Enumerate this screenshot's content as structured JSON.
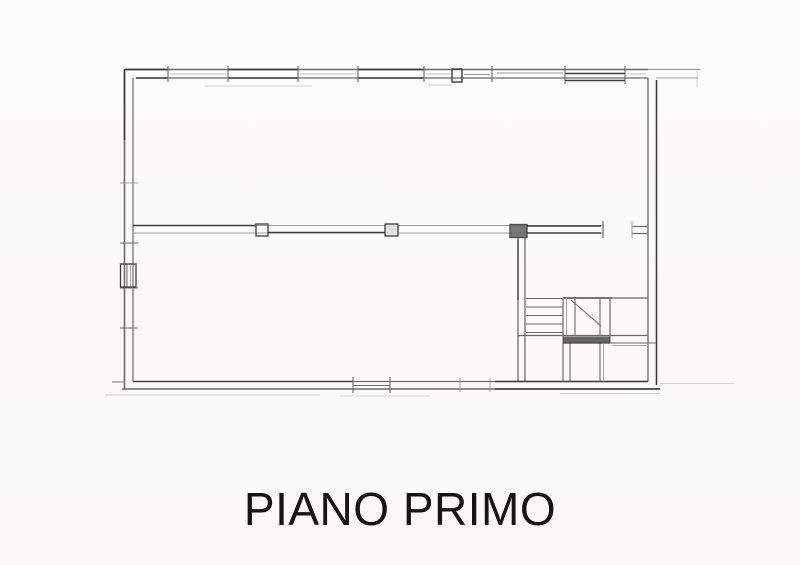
{
  "title": {
    "label": "PIANO PRIMO"
  },
  "drawing": {
    "canvas": {
      "width": 800,
      "height": 565
    },
    "ink": {
      "dark": "#3d3d3d",
      "mid": "#6a6a6a",
      "light": "#929292",
      "faint": "#b8b8b8"
    },
    "lines": [
      [
        "top-wall-outer",
        125,
        69.5,
        648,
        69.5,
        "mid",
        1.5,
        1
      ],
      [
        "top-wall-outer-extension",
        648,
        69.5,
        700,
        69.5,
        "light",
        1.3,
        0.9
      ],
      [
        "top-wall-outer-dark-1",
        125,
        69.5,
        168,
        69.5,
        "dark",
        1.7,
        1
      ],
      [
        "top-wall-outer-dark-2",
        228,
        69.5,
        298,
        69.5,
        "dark",
        1.7,
        1
      ],
      [
        "top-wall-outer-dark-3",
        358,
        69.5,
        424,
        69.5,
        "dark",
        1.7,
        1
      ],
      [
        "top-wall-inner",
        136,
        78,
        648,
        78,
        "mid",
        1.3,
        1
      ],
      [
        "top-wall-inner-dark-1",
        136,
        78,
        168,
        78,
        "dark",
        1.5,
        1
      ],
      [
        "top-wall-inner-dark-2",
        228,
        78,
        298,
        78,
        "dark",
        1.5,
        1
      ],
      [
        "top-wall-inner-dark-3",
        358,
        78,
        424,
        78,
        "dark",
        1.5,
        1
      ],
      [
        "top-wall-inner-extension",
        656,
        78,
        698,
        78,
        "light",
        1.1,
        0.85
      ],
      [
        "top-window-glass-1",
        170,
        74,
        226,
        74,
        "faint",
        1,
        0.9
      ],
      [
        "top-window-glass-2",
        300,
        74,
        356,
        74,
        "faint",
        1,
        0.9
      ],
      [
        "top-window-glass-3",
        426,
        74,
        450,
        74,
        "faint",
        1,
        0.9
      ],
      [
        "top-window-glass-4",
        464,
        74.5,
        490,
        74.5,
        "light",
        1,
        0.9
      ],
      [
        "top-window-glass-5",
        497,
        73,
        563,
        73,
        "light",
        1,
        0.9
      ],
      [
        "top-window-glass-6",
        627,
        74,
        646,
        74,
        "faint",
        1,
        0.85
      ],
      [
        "top-wall-dark-segment-upper",
        565,
        73.5,
        625,
        73.5,
        "dark",
        1.6,
        1
      ],
      [
        "top-wall-dark-segment-lower",
        565,
        80.5,
        625,
        80.5,
        "dark",
        1.6,
        1
      ],
      [
        "top-sill-faint-1",
        205,
        86,
        312,
        86,
        "faint",
        1,
        0.7
      ],
      [
        "top-sill-faint-2",
        428,
        85,
        452,
        85,
        "faint",
        1,
        0.7
      ],
      [
        "top-jamb-tick",
        168,
        66,
        168,
        82,
        "mid",
        1.1,
        1
      ],
      [
        "top-jamb-tick",
        228,
        66,
        228,
        82,
        "mid",
        1.1,
        1
      ],
      [
        "top-jamb-tick",
        298,
        66,
        298,
        82,
        "mid",
        1.1,
        1
      ],
      [
        "top-jamb-tick",
        358,
        66,
        358,
        82,
        "mid",
        1.1,
        1
      ],
      [
        "top-jamb-tick",
        424,
        66,
        424,
        82,
        "mid",
        1.1,
        1
      ],
      [
        "top-jamb-tick",
        492,
        66,
        492,
        82,
        "mid",
        1.1,
        1
      ],
      [
        "top-jamb-tick",
        565,
        66,
        565,
        84,
        "mid",
        1.1,
        1
      ],
      [
        "top-jamb-tick",
        625,
        66,
        625,
        84,
        "mid",
        1.1,
        1
      ],
      [
        "top-right-faint-vertical",
        697,
        68,
        697,
        87,
        "faint",
        1,
        0.6
      ],
      [
        "left-wall-outer",
        124.5,
        69,
        124.5,
        390,
        "mid",
        1.6,
        1
      ],
      [
        "left-wall-outer-dark",
        124.5,
        69,
        124.5,
        140,
        "dark",
        1.6,
        1
      ],
      [
        "left-wall-inner",
        133,
        78,
        133,
        381.5,
        "mid",
        1.2,
        1
      ],
      [
        "left-wall-tick",
        120,
        183,
        138,
        183,
        "light",
        1,
        0.8
      ],
      [
        "left-wall-tick",
        120,
        243,
        138,
        243,
        "mid",
        1.1,
        1
      ],
      [
        "left-wall-tick",
        120,
        288,
        138,
        288,
        "mid",
        1.1,
        1
      ],
      [
        "left-wall-tick",
        120,
        328,
        138,
        328,
        "mid",
        1.1,
        1
      ],
      [
        "left-window-mullion-1",
        127,
        264,
        127,
        287,
        "mid",
        1,
        1
      ],
      [
        "left-window-mullion-2",
        130.5,
        264,
        130.5,
        287,
        "light",
        1,
        0.8
      ],
      [
        "mid-wall-top",
        133,
        225.5,
        603,
        225.5,
        "light",
        1.1,
        0.9
      ],
      [
        "mid-wall-bottom",
        133,
        233,
        603,
        233,
        "light",
        1.1,
        0.9
      ],
      [
        "mid-wall-top-dark-1",
        133,
        225.5,
        256,
        225.5,
        "dark",
        1.5,
        1
      ],
      [
        "mid-wall-bottom-dark-1",
        268,
        232.5,
        385,
        232.5,
        "dark",
        1.4,
        1
      ],
      [
        "mid-wall-top-dark-2",
        527,
        226,
        601,
        226,
        "dark",
        1.4,
        1
      ],
      [
        "mid-wall-bottom-dark-2",
        527,
        233,
        601,
        233,
        "dark",
        1.4,
        1
      ],
      [
        "mid-wall-stub-top",
        632,
        226.5,
        648,
        226.5,
        "mid",
        1.2,
        1
      ],
      [
        "mid-wall-stub-bottom",
        632,
        233.5,
        648,
        233.5,
        "mid",
        1.2,
        1
      ],
      [
        "mid-wall-door-jamb-1",
        603,
        221,
        603,
        238,
        "mid",
        1.2,
        1
      ],
      [
        "mid-wall-door-jamb-2",
        632,
        221,
        632,
        238,
        "light",
        1,
        0.85
      ],
      [
        "stair-wall-left",
        518,
        237,
        518,
        381.5,
        "mid",
        1.3,
        1
      ],
      [
        "stair-wall-right",
        525,
        237,
        525,
        381.5,
        "mid",
        1.3,
        1
      ],
      [
        "stair-wall-left-dark",
        518,
        240,
        518,
        300,
        "dark",
        1.3,
        1
      ],
      [
        "right-wall-inner",
        648,
        78,
        648,
        381.5,
        "mid",
        1.3,
        1
      ],
      [
        "right-wall-outer",
        656.5,
        80,
        656.5,
        385,
        "dark",
        1.6,
        1
      ],
      [
        "bottom-wall-inner",
        133,
        381.5,
        648,
        381.5,
        "mid",
        1.3,
        1
      ],
      [
        "bottom-wall-outer",
        122,
        389,
        660,
        389,
        "mid",
        1.5,
        1
      ],
      [
        "bottom-wall-inner-dark-1",
        133,
        381.5,
        353,
        381.5,
        "dark",
        1.3,
        1
      ],
      [
        "bottom-wall-inner-dark-2",
        495,
        381.5,
        648,
        381.5,
        "dark",
        1.4,
        1
      ],
      [
        "bottom-wall-outer-dark",
        495,
        389,
        660,
        389,
        "dark",
        1.6,
        1
      ],
      [
        "bottom-window-glass",
        353,
        385.5,
        390,
        385.5,
        "mid",
        1,
        1
      ],
      [
        "bottom-jamb-tick",
        353,
        377,
        353,
        393,
        "mid",
        1.1,
        1
      ],
      [
        "bottom-jamb-tick",
        390,
        377,
        390,
        393,
        "mid",
        1.1,
        1
      ],
      [
        "bottom-jamb-tick",
        460,
        378,
        460,
        392,
        "light",
        1,
        0.85
      ],
      [
        "bottom-jamb-tick",
        490,
        378,
        490,
        392,
        "light",
        1,
        0.85
      ],
      [
        "bottom-left-corner-tick",
        112,
        382,
        125,
        382,
        "mid",
        1,
        0.9
      ],
      [
        "ground-faint-1",
        105,
        395,
        320,
        395,
        "faint",
        1,
        0.65
      ],
      [
        "ground-faint-2",
        340,
        396,
        430,
        396,
        "faint",
        1,
        0.55
      ],
      [
        "ground-faint-3",
        560,
        393.5,
        660,
        393.5,
        "faint",
        1,
        0.7
      ],
      [
        "bottom-extension-faint",
        660,
        383.5,
        734,
        383.5,
        "faint",
        1,
        0.6
      ],
      [
        "stair-top",
        563,
        298,
        648,
        298,
        "mid",
        1.2,
        1
      ],
      [
        "stair-top-dark",
        563,
        298,
        612,
        298,
        "dark",
        1.3,
        1
      ],
      [
        "stair-tread",
        526,
        298.5,
        563,
        298.5,
        "mid",
        1.1,
        1
      ],
      [
        "stair-tread",
        526,
        307,
        563,
        307,
        "mid",
        1.1,
        1
      ],
      [
        "stair-tread",
        526,
        315.5,
        563,
        315.5,
        "mid",
        1.1,
        1
      ],
      [
        "stair-tread",
        526,
        324,
        563,
        324,
        "mid",
        1.1,
        1
      ],
      [
        "stair-tread",
        526,
        332.5,
        563,
        332.5,
        "mid",
        1.1,
        1
      ],
      [
        "stair-vertical-a",
        563,
        298,
        563,
        343,
        "mid",
        1.2,
        1
      ],
      [
        "stair-vertical-a2",
        566.5,
        298,
        566.5,
        335.5,
        "light",
        1,
        0.8
      ],
      [
        "stair-vertical-b",
        575,
        298,
        575,
        335.5,
        "mid",
        1.1,
        1
      ],
      [
        "stair-vertical-c",
        600,
        298,
        600,
        335.5,
        "mid",
        1.1,
        1
      ],
      [
        "stair-vertical-d",
        610,
        298,
        610,
        343,
        "mid",
        1.2,
        1
      ],
      [
        "stair-cut-diagonal",
        571,
        300,
        601,
        326,
        "mid",
        1.1,
        1
      ],
      [
        "stair-block-bottom",
        518,
        335.5,
        648,
        335.5,
        "mid",
        1.2,
        1
      ],
      [
        "stair-band-bottom-edge",
        563,
        343,
        610,
        343,
        "dark",
        1.2,
        1
      ],
      [
        "stair-bottom-right",
        610,
        343,
        656,
        343,
        "mid",
        1.1,
        1
      ],
      [
        "stair-tick-row",
        612,
        345.5,
        648,
        345.5,
        "light",
        1,
        0.8
      ],
      [
        "stair-below-vertical-a",
        563,
        343,
        563,
        381.5,
        "mid",
        1.2,
        1
      ],
      [
        "stair-below-vertical-a2",
        570,
        343,
        570,
        381.5,
        "mid",
        1.1,
        1
      ],
      [
        "stair-below-vertical-b",
        600,
        343,
        600,
        381.5,
        "mid",
        1.1,
        1
      ],
      [
        "stair-below-vertical-b2",
        603.5,
        343,
        603.5,
        381.5,
        "light",
        1,
        0.8
      ]
    ],
    "rects": [
      [
        "top-wall-mullion-box",
        452,
        69,
        10,
        13,
        "dark",
        1.4,
        "none",
        1
      ],
      [
        "left-wall-window-box",
        120.5,
        264,
        15.5,
        23,
        "dark",
        1.3,
        "none",
        1
      ],
      [
        "mid-wall-jamb-box-1",
        256,
        224,
        12,
        12,
        "dark",
        1.3,
        "none",
        1
      ],
      [
        "mid-wall-jamb-box-2",
        385,
        224,
        13,
        12,
        "dark",
        1.3,
        "#e0e0de",
        1
      ],
      [
        "mid-wall-jamb-box-3",
        510,
        224.5,
        17,
        13,
        "dark",
        1.4,
        "#6a6a68",
        0.9
      ],
      [
        "stair-landing-band",
        563,
        336.5,
        47,
        6.5,
        "none",
        0,
        "#4a4a4a",
        0.85
      ]
    ]
  }
}
